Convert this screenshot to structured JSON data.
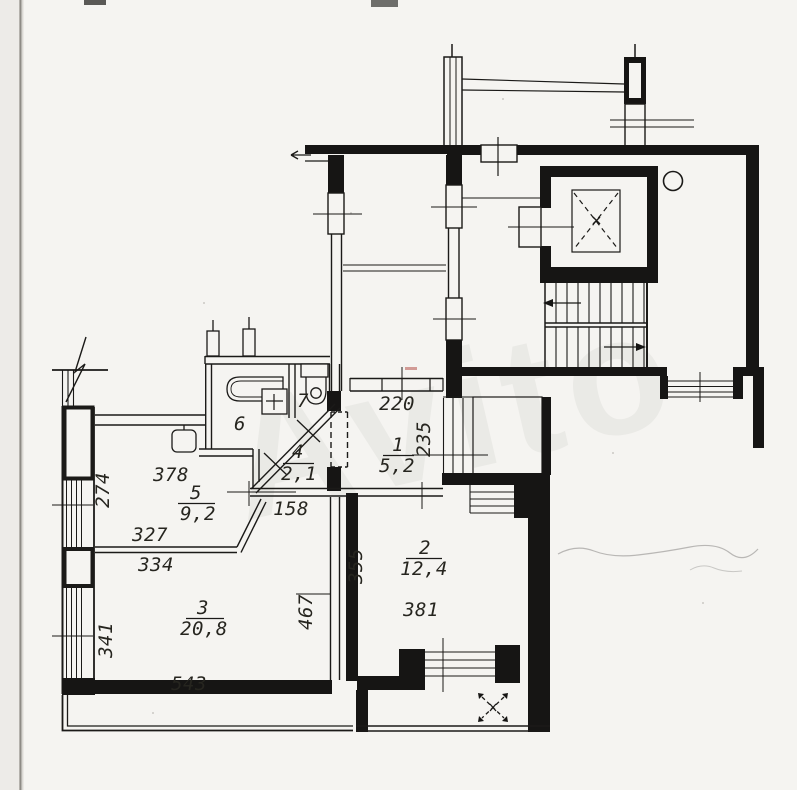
{
  "watermark": "Avito",
  "rooms": {
    "r1": {
      "number": "1",
      "area": "5,2"
    },
    "r2": {
      "number": "2",
      "area": "12,4"
    },
    "r3": {
      "number": "3",
      "area": "20,8"
    },
    "r4": {
      "number": "4",
      "area": "2,1"
    },
    "r5": {
      "number": "5",
      "area": "9,2"
    },
    "r6": {
      "number": "6"
    },
    "r7": {
      "number": "7"
    }
  },
  "dims": {
    "d220": "220",
    "d235": "235",
    "d158": "158",
    "d274": "274",
    "d327": "327",
    "d334": "334",
    "d341": "341",
    "d355": "355",
    "d378": "378",
    "d381": "381",
    "d467": "467",
    "d543": "543"
  }
}
